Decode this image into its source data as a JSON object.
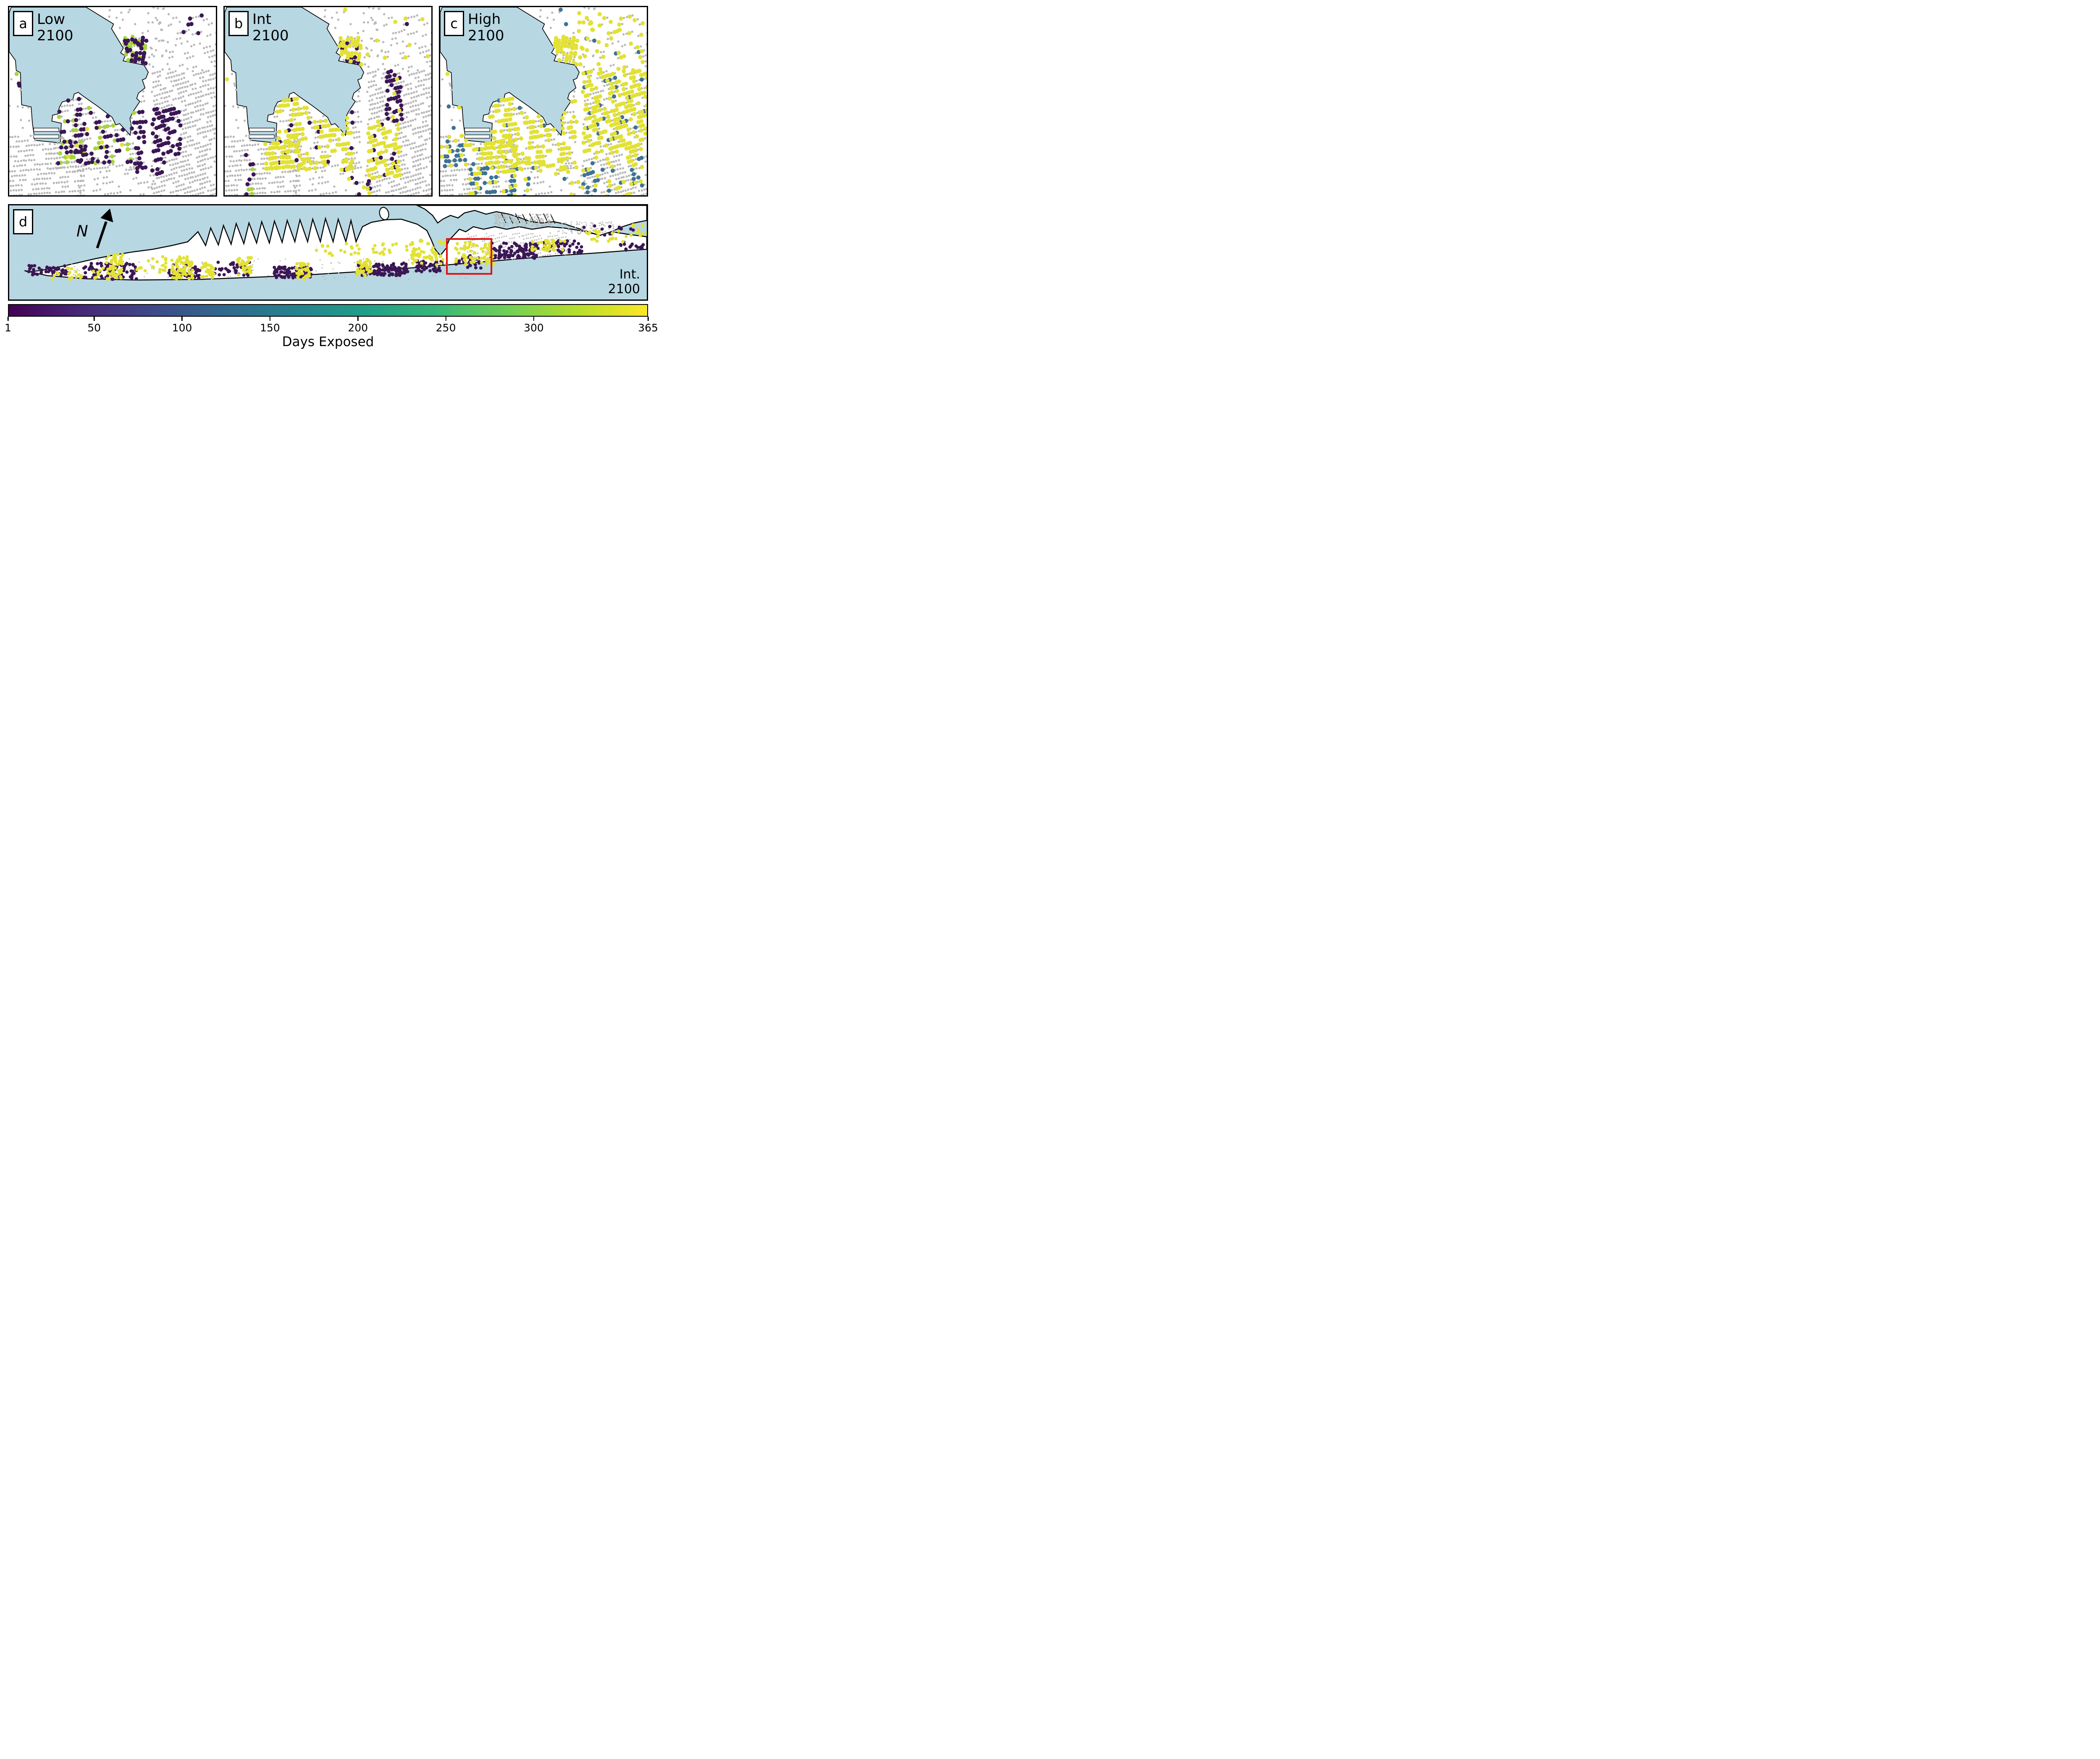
{
  "figure": {
    "description": "Building flood-exposure maps under three sea-level-rise scenarios with overview map and colorbar"
  },
  "panels": {
    "a": {
      "letter": "a",
      "scenario": "Low",
      "year": "2100",
      "zones": [
        {
          "rect": [
            552,
            130,
            665,
            280
          ],
          "p": {
            "purple": 0.42,
            "lime": 0.33
          }
        },
        {
          "rect": [
            195,
            425,
            232,
            570
          ],
          "p": {
            "purple": 0.55
          }
        },
        {
          "rect": [
            232,
            420,
            610,
            740
          ],
          "p": {
            "purple": 0.3,
            "lime": 0.16,
            "yellow": 0.02
          }
        },
        {
          "rect": [
            598,
            480,
            830,
            700
          ],
          "p": {
            "purple": 0.72
          }
        },
        {
          "rect": [
            610,
            700,
            762,
            792
          ],
          "p": {
            "purple": 0.45
          }
        },
        {
          "rect": [
            840,
            0,
            1005,
            150
          ],
          "p": {
            "purple": 0.1
          }
        },
        {
          "rect": [
            0,
            250,
            80,
            420
          ],
          "p": {
            "purple": 0.08,
            "lime": 0.08
          }
        }
      ]
    },
    "b": {
      "letter": "b",
      "scenario": "Int",
      "year": "2100",
      "zones": [
        {
          "rect": [
            552,
            130,
            665,
            280
          ],
          "p": {
            "yellow": 0.55,
            "purple": 0.12
          }
        },
        {
          "rect": [
            495,
            410,
            575,
            660
          ],
          "p": {
            "yellow": 0.78
          }
        },
        {
          "rect": [
            195,
            410,
            620,
            770
          ],
          "p": {
            "yellow": 0.6,
            "purple": 0.06
          }
        },
        {
          "rect": [
            690,
            540,
            850,
            810
          ],
          "p": {
            "yellow": 0.6,
            "purple": 0.1
          }
        },
        {
          "rect": [
            780,
            290,
            865,
            540
          ],
          "p": {
            "purple": 0.45,
            "yellow": 0.08
          }
        },
        {
          "rect": [
            575,
            780,
            705,
            892
          ],
          "p": {
            "yellow": 0.45,
            "purple": 0.28
          }
        },
        {
          "rect": [
            100,
            680,
            142,
            892
          ],
          "p": {
            "purple": 0.45,
            "lime": 0.15
          }
        },
        {
          "rect": [
            560,
            0,
            1005,
            290
          ],
          "p": {
            "yellow": 0.1,
            "purple": 0.05
          }
        },
        {
          "rect": [
            0,
            250,
            120,
            480
          ],
          "p": {
            "yellow": 0.1,
            "purple": 0.06
          }
        }
      ]
    },
    "c": {
      "letter": "c",
      "scenario": "High",
      "year": "2100",
      "zones": [
        {
          "rect": [
            552,
            130,
            665,
            280
          ],
          "p": {
            "yellow": 0.8
          }
        },
        {
          "rect": [
            225,
            345,
            305,
            425
          ],
          "p": {
            "teal": 0.65,
            "yellow": 0.1
          }
        },
        {
          "rect": [
            385,
            385,
            465,
            485
          ],
          "p": {
            "teal": 0.55,
            "yellow": 0.2
          }
        },
        {
          "rect": [
            20,
            550,
            115,
            715
          ],
          "p": {
            "teal": 0.45,
            "yellow": 0.22
          }
        },
        {
          "rect": [
            140,
            760,
            275,
            895
          ],
          "p": {
            "teal": 0.4,
            "yellow": 0.3
          }
        },
        {
          "rect": [
            300,
            790,
            435,
            895
          ],
          "p": {
            "teal": 0.35,
            "yellow": 0.3
          }
        },
        {
          "rect": [
            540,
            800,
            650,
            892
          ],
          "p": {
            "teal": 0.45,
            "yellow": 0.15
          }
        },
        {
          "rect": [
            670,
            760,
            780,
            870
          ],
          "p": {
            "teal": 0.4,
            "yellow": 0.2
          }
        },
        {
          "rect": [
            870,
            690,
            1005,
            850
          ],
          "p": {
            "teal": 0.3,
            "yellow": 0.15
          }
        },
        {
          "rect": [
            195,
            400,
            660,
            790
          ],
          "p": {
            "yellow": 0.62,
            "teal": 0.03
          }
        },
        {
          "rect": [
            660,
            290,
            1005,
            690
          ],
          "p": {
            "yellow": 0.66,
            "teal": 0.08
          }
        },
        {
          "rect": [
            660,
            690,
            1005,
            900
          ],
          "p": {
            "yellow": 0.15,
            "teal": 0.08
          }
        },
        {
          "rect": [
            560,
            0,
            1005,
            290
          ],
          "p": {
            "yellow": 0.42,
            "teal": 0.04
          }
        },
        {
          "rect": [
            0,
            250,
            195,
            600
          ],
          "p": {
            "yellow": 0.25,
            "teal": 0.18
          }
        },
        {
          "rect": [
            240,
            510,
            560,
            620
          ],
          "p": {
            "yellow": 0.55
          }
        },
        {
          "rect": [
            0,
            600,
            195,
            760
          ],
          "p": {
            "yellow": 0.25,
            "teal": 0.25
          }
        }
      ]
    },
    "d": {
      "letter": "d",
      "scenario": "Int.",
      "year": "2100",
      "north_label": "N",
      "inset_box": {
        "x": 0.685,
        "y": 0.347,
        "w": 0.067,
        "h": 0.353
      },
      "clusters": {
        "purple": [
          [
            30,
            96,
            92,
            112,
            45
          ],
          [
            115,
            92,
            200,
            118,
            90
          ],
          [
            250,
            95,
            300,
            116,
            40
          ],
          [
            322,
            90,
            380,
            112,
            40
          ],
          [
            415,
            98,
            475,
            116,
            80
          ],
          [
            545,
            92,
            625,
            112,
            110
          ],
          [
            638,
            88,
            680,
            106,
            45
          ],
          [
            755,
            60,
            830,
            85,
            110
          ],
          [
            838,
            56,
            898,
            76,
            45
          ],
          [
            958,
            58,
            1000,
            72,
            16
          ],
          [
            700,
            80,
            742,
            100,
            25
          ],
          [
            900,
            30,
            980,
            48,
            12
          ]
        ],
        "yellow": [
          [
            152,
            78,
            178,
            118,
            55
          ],
          [
            255,
            82,
            288,
            118,
            70
          ],
          [
            300,
            92,
            322,
            116,
            25
          ],
          [
            358,
            82,
            380,
            112,
            35
          ],
          [
            450,
            92,
            472,
            118,
            35
          ],
          [
            545,
            86,
            568,
            112,
            40
          ],
          [
            630,
            55,
            688,
            95,
            55
          ],
          [
            700,
            58,
            760,
            95,
            70
          ],
          [
            820,
            52,
            872,
            72,
            35
          ],
          [
            900,
            40,
            980,
            58,
            22
          ],
          [
            60,
            98,
            150,
            118,
            25
          ],
          [
            480,
            60,
            640,
            80,
            40
          ],
          [
            978,
            28,
            1000,
            48,
            10
          ],
          [
            200,
            80,
            250,
            112,
            20
          ]
        ],
        "gray_scatter": [
          [
            760,
            14,
            852,
            34,
            240
          ],
          [
            858,
            26,
            950,
            46,
            110
          ],
          [
            80,
            85,
            720,
            118,
            160
          ]
        ]
      }
    }
  },
  "colorbar": {
    "label": "Days Exposed",
    "min": 1,
    "max": 365,
    "ticks": [
      1,
      50,
      100,
      150,
      200,
      250,
      300,
      365
    ],
    "colormap": "viridis",
    "stops": [
      "#440154",
      "#482878",
      "#3e4989",
      "#31688e",
      "#26828e",
      "#1f9e89",
      "#35b779",
      "#6ece58",
      "#b5de2b",
      "#fde725"
    ]
  },
  "colors": {
    "water": "#b7d7e2",
    "land": "#ffffff",
    "coast": "#000000",
    "inset_red": "#e01212",
    "dot": {
      "purple": "#3b1654",
      "lime": "#a9d43c",
      "yellow": "#e2e135",
      "teal": "#3d7294",
      "gray": "#b9b9b9"
    }
  }
}
